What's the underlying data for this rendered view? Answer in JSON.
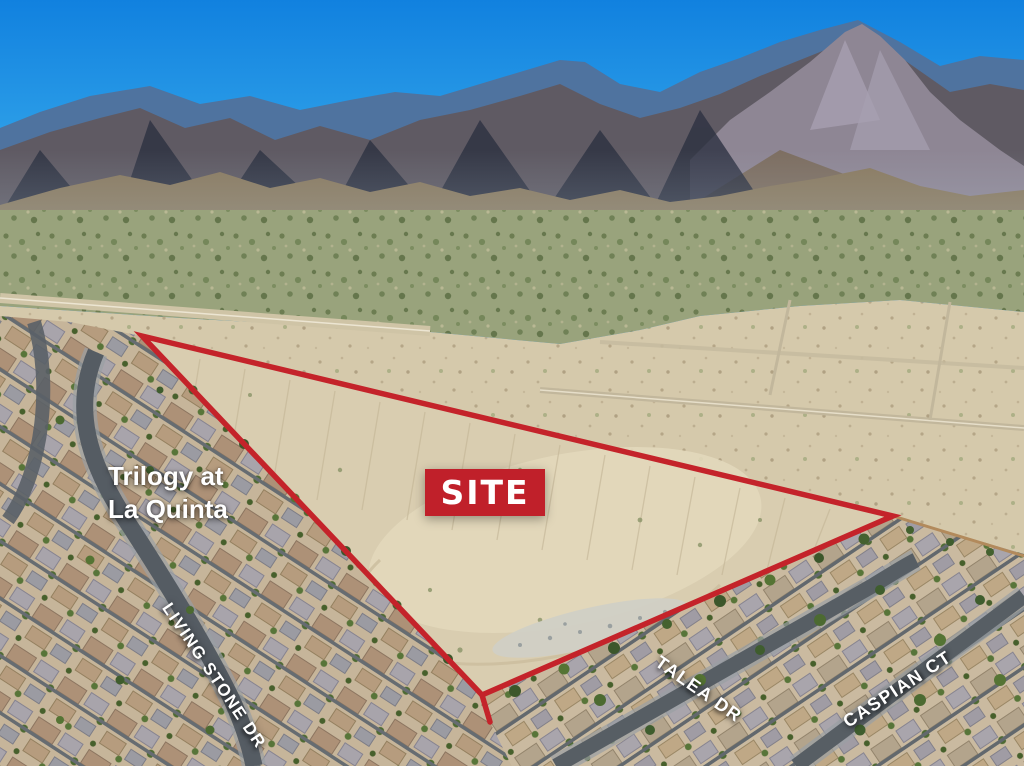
{
  "annotations": {
    "site_badge": "SITE",
    "community": {
      "line1": "Trilogy at",
      "line2": "La Quinta"
    },
    "streets": {
      "living_stone": "LIVING STONE DR",
      "talea": "TALEA DR",
      "caspian": "CASPIAN CT"
    }
  },
  "colors": {
    "boundary_red": "#c4232a",
    "badge_red": "#c0202a",
    "label_white": "#ffffff",
    "sky_blue": "#1488e8"
  }
}
